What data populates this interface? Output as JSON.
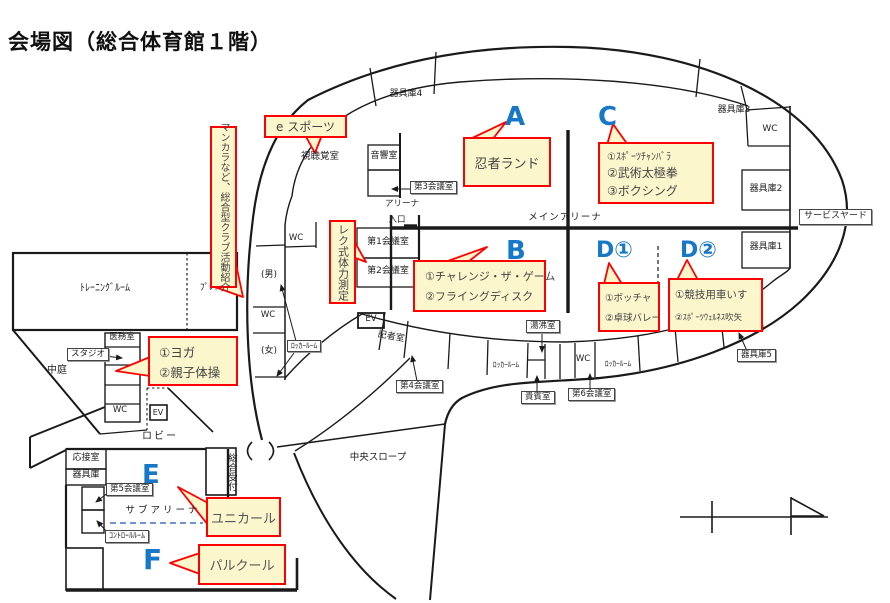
{
  "title": "会場図（総合体育館１階）",
  "zones": {
    "a": "A",
    "b": "B",
    "c": "C",
    "d1": "D①",
    "d2": "D②",
    "e": "E",
    "f": "F"
  },
  "callouts": {
    "esports": "e スポーツ",
    "mancala": "マンカラなど、総合型クラブ活動紹介",
    "rec_check": "レク式体力測定",
    "ninja": "忍者ランド",
    "c1": "①ｽﾎﾟｰﾂﾁｬﾝﾊﾞﾗ",
    "c2": "②武術太極拳",
    "c3": "③ボクシング",
    "b1": "①チャレンジ・ザ・ゲーム",
    "b2": "②フライングディスク",
    "d1_1": "①ボッチャ",
    "d1_2": "②卓球バレー",
    "d2_1": "①競技用車いす",
    "d2_2": "②ｽﾎﾟｰﾂｳｪﾙﾈｽ吹矢",
    "yoga1": "①ヨガ",
    "yoga2": "②親子体操",
    "unicurl": "ユニカール",
    "parkour": "パルクール"
  },
  "rooms": {
    "kiguko4": "器具庫4",
    "kiguko3": "器具庫3",
    "kiguko2": "器具庫2",
    "kiguko1": "器具庫1",
    "kiguko5": "器具庫5",
    "kiguko": "器具庫",
    "wc": "WC",
    "ev": "EV",
    "service_yard": "サービスヤード",
    "shichokaku": "視聴覚室",
    "onkyo": "音響室",
    "kaigi1": "第1会議室",
    "kaigi2": "第2会議室",
    "kaigi3": "第3会議室",
    "kaigi4": "第4会議室",
    "kaigi5": "第5会議室",
    "kaigi6": "第6会議室",
    "arena": "アリーナ",
    "entrance": "入口",
    "main_arena": "メインアリーナ",
    "men": "(男)",
    "women": "(女)",
    "locker": "ﾛｯｶｰﾙｰﾑ",
    "training": "ﾄﾚｰﾆﾝｸﾞﾙｰﾑ",
    "play": "ﾌﾟﾚｲ",
    "imu": "医務室",
    "studio": "スタジオ",
    "nakaniwa": "中庭",
    "lobby": "ロビー",
    "kisha": "記者室",
    "yuwakashi": "湯沸室",
    "kihin": "貴賓室",
    "osetsu": "応接室",
    "sub_arena": "サブアリーナ",
    "control": "ｺﾝﾄﾛｰﾙﾙｰﾑ",
    "uketsuke": "総合受付",
    "slope": "中央スロープ"
  },
  "colors": {
    "callout_bg": "#fcf6cd",
    "callout_border": "#ff0000",
    "zone_letter": "#1778c8",
    "line": "#1a1a1a",
    "sub_arena_divider": "#4472c4"
  }
}
